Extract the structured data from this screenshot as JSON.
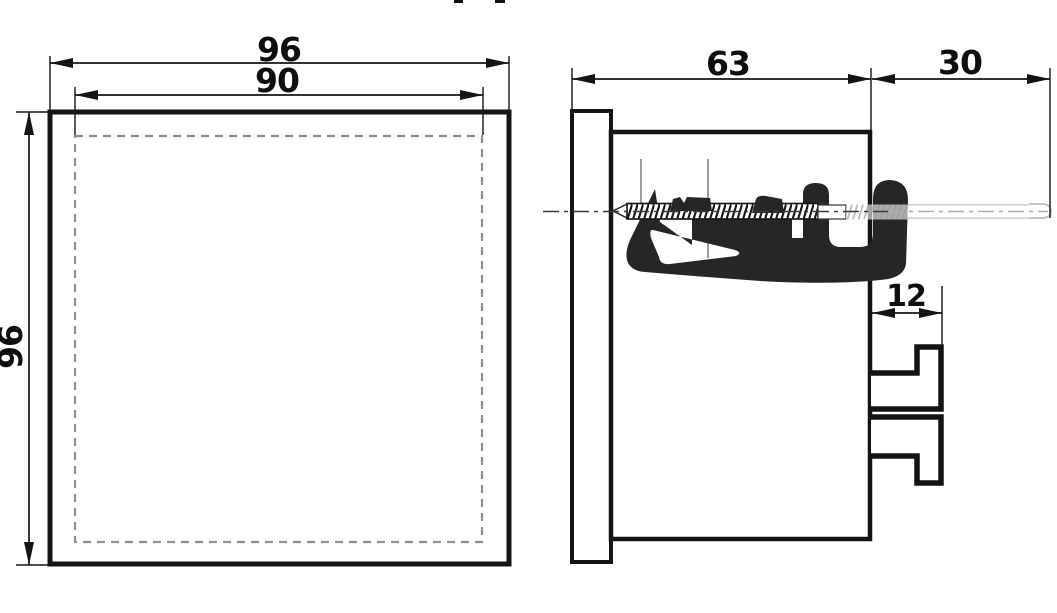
{
  "drawing": {
    "description": "Dimensional outline drawing of a 96x96 panel-mount instrument, front and side views",
    "front_view": {
      "width_label": "96",
      "height_label": "96",
      "cutout_label": "90"
    },
    "side_view": {
      "depth_label": "63",
      "rear_clearance_label": "30",
      "terminal_depth_label": "12"
    },
    "colors": {
      "line": "#141414",
      "cutout_dashed": "#8f8f8f",
      "clamp_fill": "#262626",
      "ghost_gray": "#bdbdbd",
      "background": "#ffffff"
    }
  }
}
